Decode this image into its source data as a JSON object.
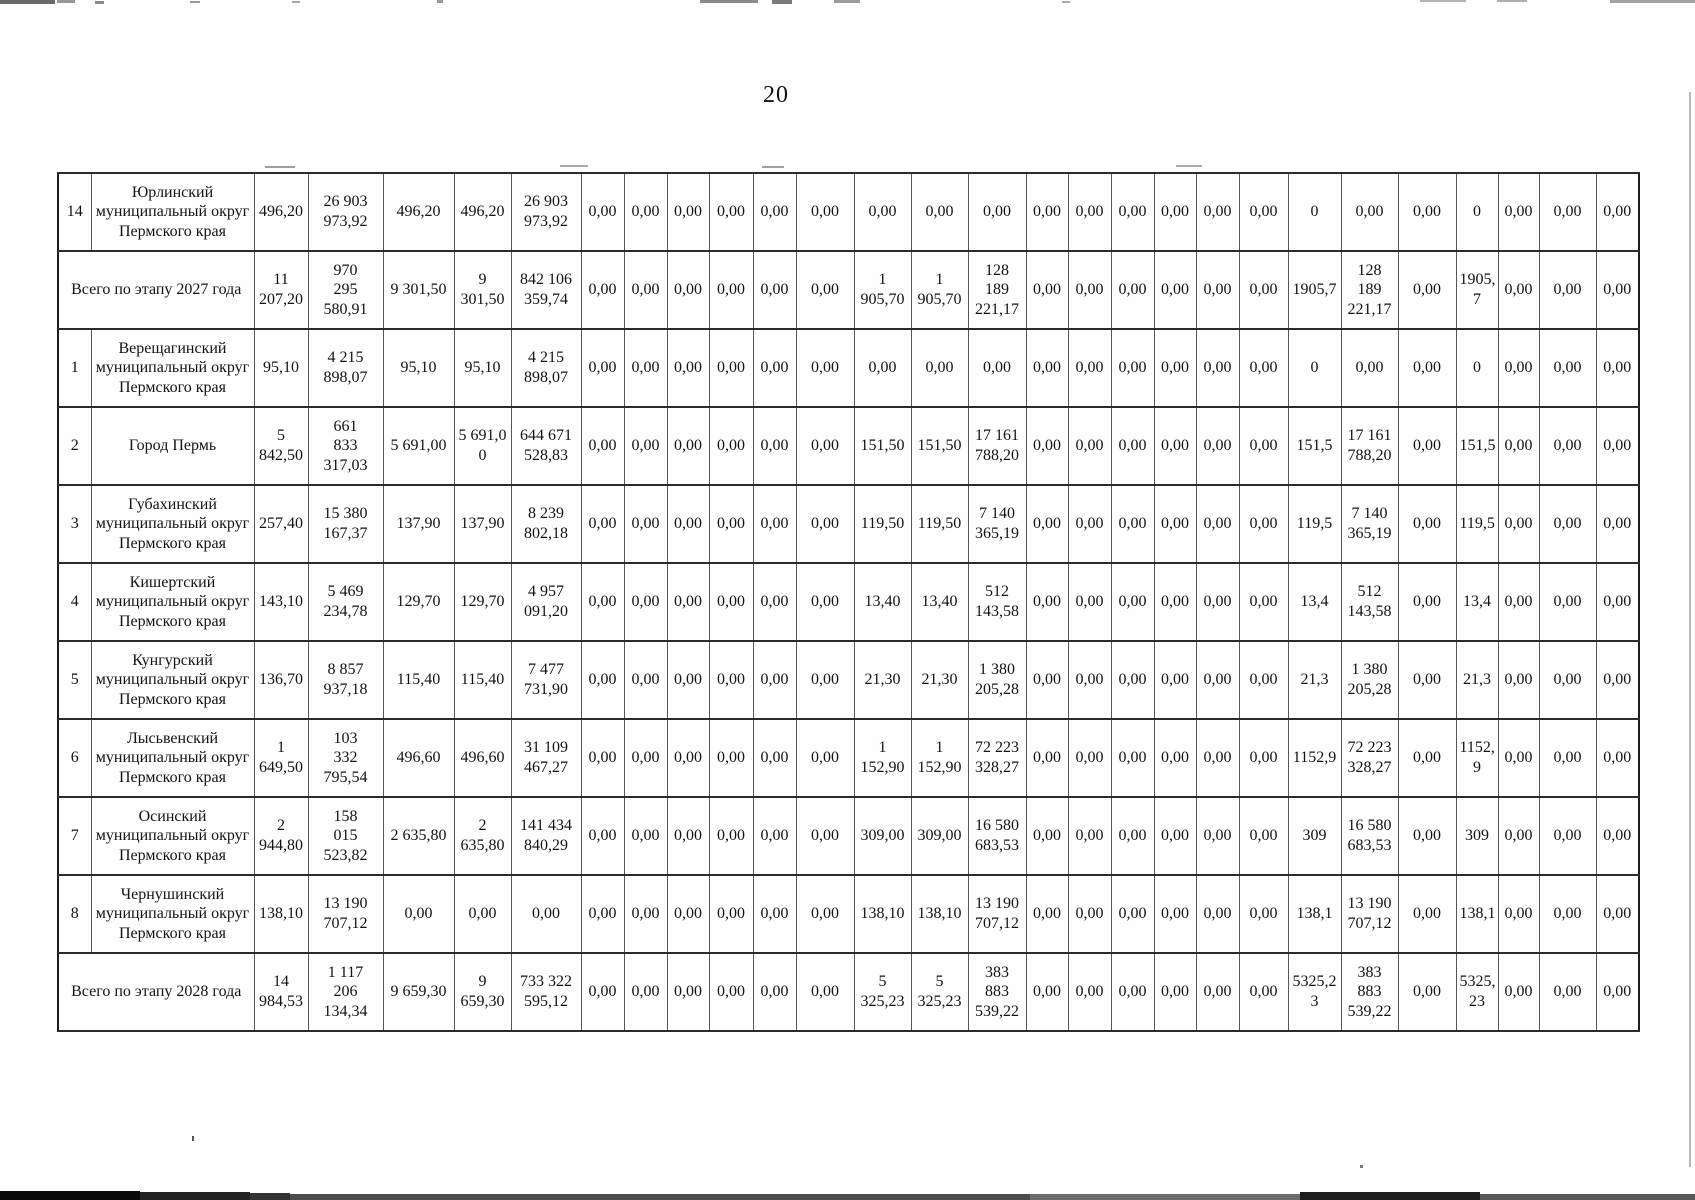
{
  "page": {
    "number": "20"
  },
  "table": {
    "col_widths": [
      33,
      163,
      54,
      75,
      71,
      57,
      70,
      43,
      43,
      42,
      44,
      43,
      58,
      57,
      57,
      58,
      42,
      43,
      43,
      42,
      43,
      49,
      53,
      57,
      58,
      42,
      41,
      57,
      43
    ],
    "rows": [
      {
        "no": "14",
        "name": "Юрлинский\nмуниципальный округ\nПермского края",
        "cells": [
          "496,20",
          "26 903\n973,92",
          "496,20",
          "496,20",
          "26 903\n973,92",
          "0,00",
          "0,00",
          "0,00",
          "0,00",
          "0,00",
          "0,00",
          "0,00",
          "0,00",
          "0,00",
          "0,00",
          "0,00",
          "0,00",
          "0,00",
          "0,00",
          "0,00",
          "0",
          "0,00",
          "0,00",
          "0",
          "0,00",
          "0,00",
          "0,00"
        ]
      },
      {
        "label": "Всего по этапу 2027 года",
        "cells": [
          "11\n207,20",
          "970\n295\n580,91",
          "9 301,50",
          "9\n301,50",
          "842 106\n359,74",
          "0,00",
          "0,00",
          "0,00",
          "0,00",
          "0,00",
          "0,00",
          "1\n905,70",
          "1\n905,70",
          "128\n189\n221,17",
          "0,00",
          "0,00",
          "0,00",
          "0,00",
          "0,00",
          "0,00",
          "1905,7",
          "128\n189\n221,17",
          "0,00",
          "1905,\n7",
          "0,00",
          "0,00",
          "0,00"
        ]
      },
      {
        "no": "1",
        "name": "Верещагинский\nмуниципальный округ\nПермского края",
        "cells": [
          "95,10",
          "4 215\n898,07",
          "95,10",
          "95,10",
          "4 215\n898,07",
          "0,00",
          "0,00",
          "0,00",
          "0,00",
          "0,00",
          "0,00",
          "0,00",
          "0,00",
          "0,00",
          "0,00",
          "0,00",
          "0,00",
          "0,00",
          "0,00",
          "0,00",
          "0",
          "0,00",
          "0,00",
          "0",
          "0,00",
          "0,00",
          "0,00"
        ]
      },
      {
        "no": "2",
        "name": "Город Пермь",
        "cells": [
          "5\n842,50",
          "661\n833\n317,03",
          "5 691,00",
          "5 691,0\n0",
          "644 671\n528,83",
          "0,00",
          "0,00",
          "0,00",
          "0,00",
          "0,00",
          "0,00",
          "151,50",
          "151,50",
          "17 161\n788,20",
          "0,00",
          "0,00",
          "0,00",
          "0,00",
          "0,00",
          "0,00",
          "151,5",
          "17 161\n788,20",
          "0,00",
          "151,5",
          "0,00",
          "0,00",
          "0,00"
        ]
      },
      {
        "no": "3",
        "name": "Губахинский\nмуниципальный округ\nПермского края",
        "cells": [
          "257,40",
          "15 380\n167,37",
          "137,90",
          "137,90",
          "8 239\n802,18",
          "0,00",
          "0,00",
          "0,00",
          "0,00",
          "0,00",
          "0,00",
          "119,50",
          "119,50",
          "7 140\n365,19",
          "0,00",
          "0,00",
          "0,00",
          "0,00",
          "0,00",
          "0,00",
          "119,5",
          "7 140\n365,19",
          "0,00",
          "119,5",
          "0,00",
          "0,00",
          "0,00"
        ]
      },
      {
        "no": "4",
        "name": "Кишертский\nмуниципальный округ\nПермского края",
        "cells": [
          "143,10",
          "5 469\n234,78",
          "129,70",
          "129,70",
          "4 957\n091,20",
          "0,00",
          "0,00",
          "0,00",
          "0,00",
          "0,00",
          "0,00",
          "13,40",
          "13,40",
          "512\n143,58",
          "0,00",
          "0,00",
          "0,00",
          "0,00",
          "0,00",
          "0,00",
          "13,4",
          "512\n143,58",
          "0,00",
          "13,4",
          "0,00",
          "0,00",
          "0,00"
        ]
      },
      {
        "no": "5",
        "name": "Кунгурский\nмуниципальный округ\nПермского края",
        "cells": [
          "136,70",
          "8 857\n937,18",
          "115,40",
          "115,40",
          "7 477\n731,90",
          "0,00",
          "0,00",
          "0,00",
          "0,00",
          "0,00",
          "0,00",
          "21,30",
          "21,30",
          "1 380\n205,28",
          "0,00",
          "0,00",
          "0,00",
          "0,00",
          "0,00",
          "0,00",
          "21,3",
          "1 380\n205,28",
          "0,00",
          "21,3",
          "0,00",
          "0,00",
          "0,00"
        ]
      },
      {
        "no": "6",
        "name": "Лысьвенский\nмуниципальный округ\nПермского края",
        "cells": [
          "1\n649,50",
          "103\n332\n795,54",
          "496,60",
          "496,60",
          "31 109\n467,27",
          "0,00",
          "0,00",
          "0,00",
          "0,00",
          "0,00",
          "0,00",
          "1\n152,90",
          "1\n152,90",
          "72 223\n328,27",
          "0,00",
          "0,00",
          "0,00",
          "0,00",
          "0,00",
          "0,00",
          "1152,9",
          "72 223\n328,27",
          "0,00",
          "1152,\n9",
          "0,00",
          "0,00",
          "0,00"
        ]
      },
      {
        "no": "7",
        "name": "Осинский\nмуниципальный округ\nПермского края",
        "cells": [
          "2\n944,80",
          "158\n015\n523,82",
          "2 635,80",
          "2\n635,80",
          "141 434\n840,29",
          "0,00",
          "0,00",
          "0,00",
          "0,00",
          "0,00",
          "0,00",
          "309,00",
          "309,00",
          "16 580\n683,53",
          "0,00",
          "0,00",
          "0,00",
          "0,00",
          "0,00",
          "0,00",
          "309",
          "16 580\n683,53",
          "0,00",
          "309",
          "0,00",
          "0,00",
          "0,00"
        ]
      },
      {
        "no": "8",
        "name": "Чернушинский\nмуниципальный округ\nПермского края",
        "cells": [
          "138,10",
          "13 190\n707,12",
          "0,00",
          "0,00",
          "0,00",
          "0,00",
          "0,00",
          "0,00",
          "0,00",
          "0,00",
          "0,00",
          "138,10",
          "138,10",
          "13 190\n707,12",
          "0,00",
          "0,00",
          "0,00",
          "0,00",
          "0,00",
          "0,00",
          "138,1",
          "13 190\n707,12",
          "0,00",
          "138,1",
          "0,00",
          "0,00",
          "0,00"
        ]
      },
      {
        "label": "Всего по этапу 2028 года",
        "cells": [
          "14\n984,53",
          "1 117\n206\n134,34",
          "9 659,30",
          "9\n659,30",
          "733 322\n595,12",
          "0,00",
          "0,00",
          "0,00",
          "0,00",
          "0,00",
          "0,00",
          "5\n325,23",
          "5\n325,23",
          "383\n883\n539,22",
          "0,00",
          "0,00",
          "0,00",
          "0,00",
          "0,00",
          "0,00",
          "5325,2\n3",
          "383\n883\n539,22",
          "0,00",
          "5325,\n23",
          "0,00",
          "0,00",
          "0,00"
        ]
      }
    ]
  }
}
